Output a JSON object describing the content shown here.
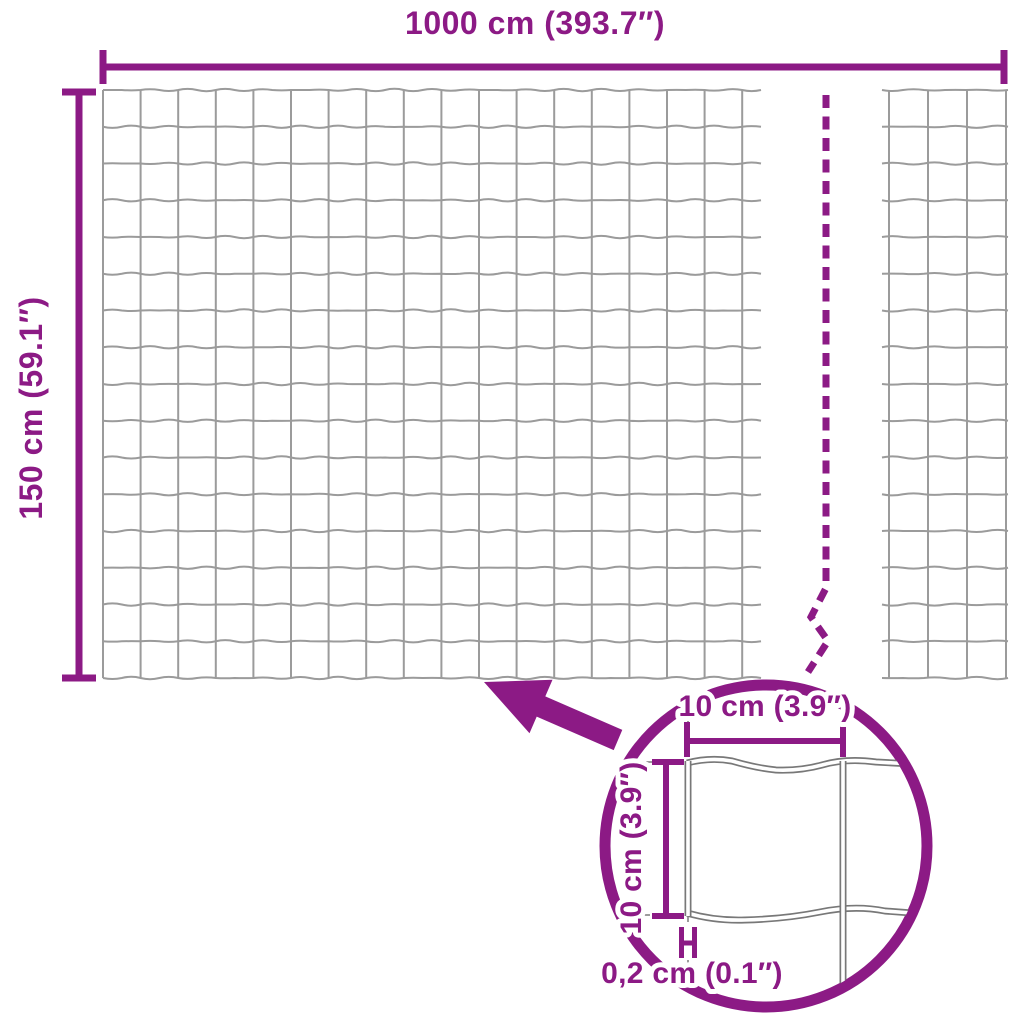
{
  "labels": {
    "width": "1000 cm (393.7″)",
    "height": "150 cm (59.1″)",
    "cell_width": "10 cm (3.9″)",
    "cell_height": "10 cm (3.9″)",
    "wire_thickness": "0,2 cm (0.1″)"
  },
  "colors": {
    "accent": "#8c1a85",
    "wire": "#9b9b9b",
    "detail_wire": "#787878"
  }
}
